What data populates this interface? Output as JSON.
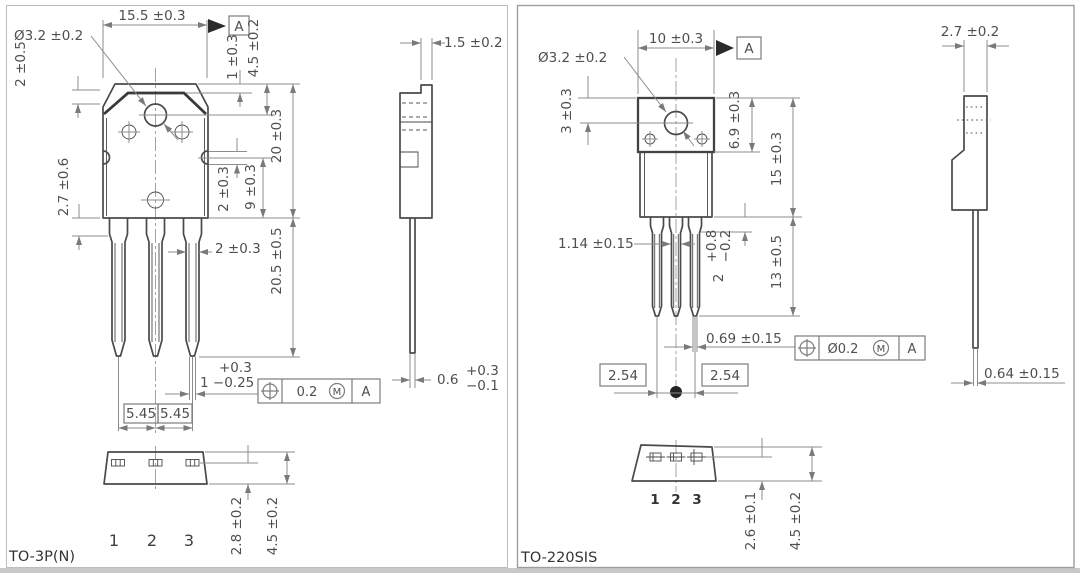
{
  "colors": {
    "outline": "#4a4a4a",
    "dimension_line": "#8c8c8c",
    "label_text": "#4f4f4f",
    "datum_fill": "#2b2b2b"
  },
  "left": {
    "package_label": "TO-3P(N)",
    "datum": "A",
    "front": {
      "top_width": "15.5 ±0.3",
      "hole_diameter": "Ø3.2 ±0.2",
      "chamfer_height": "2 ±0.5",
      "tab_edge_offset": "1 ±0.3",
      "hole_center_offset": "4.5 ±0.2",
      "body_height": "20 ±0.3",
      "shoulder_height": "2.7 ±0.6",
      "notch_diameter": "2 ±0.3",
      "notch_to_base": "9 ±0.3",
      "lead_width": "2 ±0.3",
      "lead_length": "20.5 ±0.5",
      "lead_thickness_upper": "+0.3",
      "lead_thickness_lower": "1 −0.25",
      "pitch_left": "5.45",
      "pitch_right": "5.45"
    },
    "fcf": {
      "tolerance": "0.2",
      "modifier": "M",
      "datum": "A"
    },
    "side": {
      "tab_thickness": "1.5 ±0.2",
      "lead_value": "0.6",
      "lead_upper": "+0.3",
      "lead_lower": "−0.1"
    },
    "bottom": {
      "inner_height": "2.8 ±0.2",
      "outer_height": "4.5 ±0.2",
      "pins": [
        "1",
        "2",
        "3"
      ]
    }
  },
  "right": {
    "package_label": "TO-220SIS",
    "datum": "A",
    "front": {
      "top_width": "10 ±0.3",
      "hole_diameter": "Ø3.2 ±0.2",
      "hole_center_offset": "3 ±0.3",
      "tab_height": "6.9 ±0.3",
      "body_height": "15 ±0.3",
      "lead_width": "1.14 ±0.15",
      "shoulder_value": "2",
      "shoulder_upper": "+0.8",
      "shoulder_lower": "−0.2",
      "lead_length": "13 ±0.5",
      "lead_thickness": "0.69 ±0.15",
      "pitch_left": "2.54",
      "pitch_right": "2.54"
    },
    "fcf": {
      "tolerance": "Ø0.2",
      "modifier": "M",
      "datum": "A"
    },
    "side": {
      "body_thickness": "2.7 ±0.2",
      "lead_thickness": "0.64 ±0.15"
    },
    "bottom": {
      "inner_height": "2.6 ±0.1",
      "outer_height": "4.5 ±0.2",
      "pins": [
        "1",
        "2",
        "3"
      ]
    }
  }
}
